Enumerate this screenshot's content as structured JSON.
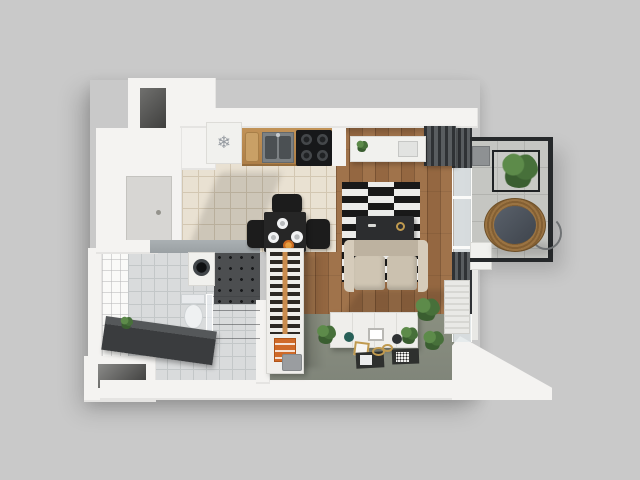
{
  "scene": {
    "type": "3d-floorplan-top-view",
    "description": "cutaway top-down 3D render of a studio apartment with balcony",
    "rooms": [
      "kitchen",
      "bathroom",
      "living-room",
      "dining-nook",
      "entry-hall",
      "balcony"
    ],
    "furniture": [
      "fridge",
      "wood-counter",
      "sink",
      "cooktop",
      "dining-table",
      "three-chairs",
      "wine-rack-divider",
      "washing-machine",
      "toilet",
      "vanity",
      "dark-counter",
      "glass-shower-pane",
      "striped-rug",
      "coffee-table",
      "sofa",
      "console-table",
      "vertical-blinds",
      "radiator",
      "sideboard",
      "floor-mats-with-frames",
      "plant-stand",
      "rattan-egg-chair",
      "plants"
    ]
  },
  "icons": {
    "fridge_snowflake": "❄"
  },
  "colors": {
    "bg": "#c9c9c9",
    "wall": "#f4f3f1",
    "niche1": "#70706e",
    "niche2": "#2f2f2e",
    "kitchenFloor": "#e9e1d2",
    "kitchenLine": "#d3c7b2",
    "wood": "#a0734b",
    "woodDark": "#946741",
    "bathTile": "#d9dbdc",
    "bathLine": "#c3c7c8",
    "tileWall": "#fafaf8",
    "darkTile": "#4c4e50",
    "dot": "#17181a",
    "counterDark": "#3a3c3e",
    "counterTop": "#55585a",
    "steel": "#9aa0a3",
    "olive": "#80857a",
    "concrete": "#c5c6c2",
    "concreteLine": "#b2b3af",
    "rail": "#26292b",
    "rug1": "#191919",
    "rug2": "#ececea",
    "sofa": "#cfc5b3",
    "sofaShade": "#bdb2a0",
    "tableDark": "#262626",
    "chairDark": "#1c1c1c",
    "ctable": "#2c2d2f",
    "rack": "#efeeeb",
    "bottle": "#2c2824",
    "cap": "#c98c4f",
    "poster": "#cf6a29",
    "blindA": "#2f3235",
    "blindB": "#595d60",
    "glass": "rgba(223,230,234,0.65)",
    "radiator": "#e9e9e6",
    "radiatorRib": "#d7d7d3",
    "appliance": "#f1f1ee",
    "sinkSteel": "#7c8184",
    "basin": "#4b5053",
    "cooktop": "#17181a",
    "burner": "#44474a",
    "plate": "#f2f3f4",
    "bowl": "#cc6a22",
    "plantA": "#5d8b4a",
    "plantB": "#47703a",
    "plantC": "#3a5e30",
    "rattan": "#9a7342",
    "rattanDark": "#835f33",
    "cushion": "#3e444c",
    "teal": "#275f57",
    "gold": "#c09a4f",
    "mat": "#2e302e",
    "doorPanel": "#d7d6d3",
    "fridgeIcon": "#959aa0"
  }
}
